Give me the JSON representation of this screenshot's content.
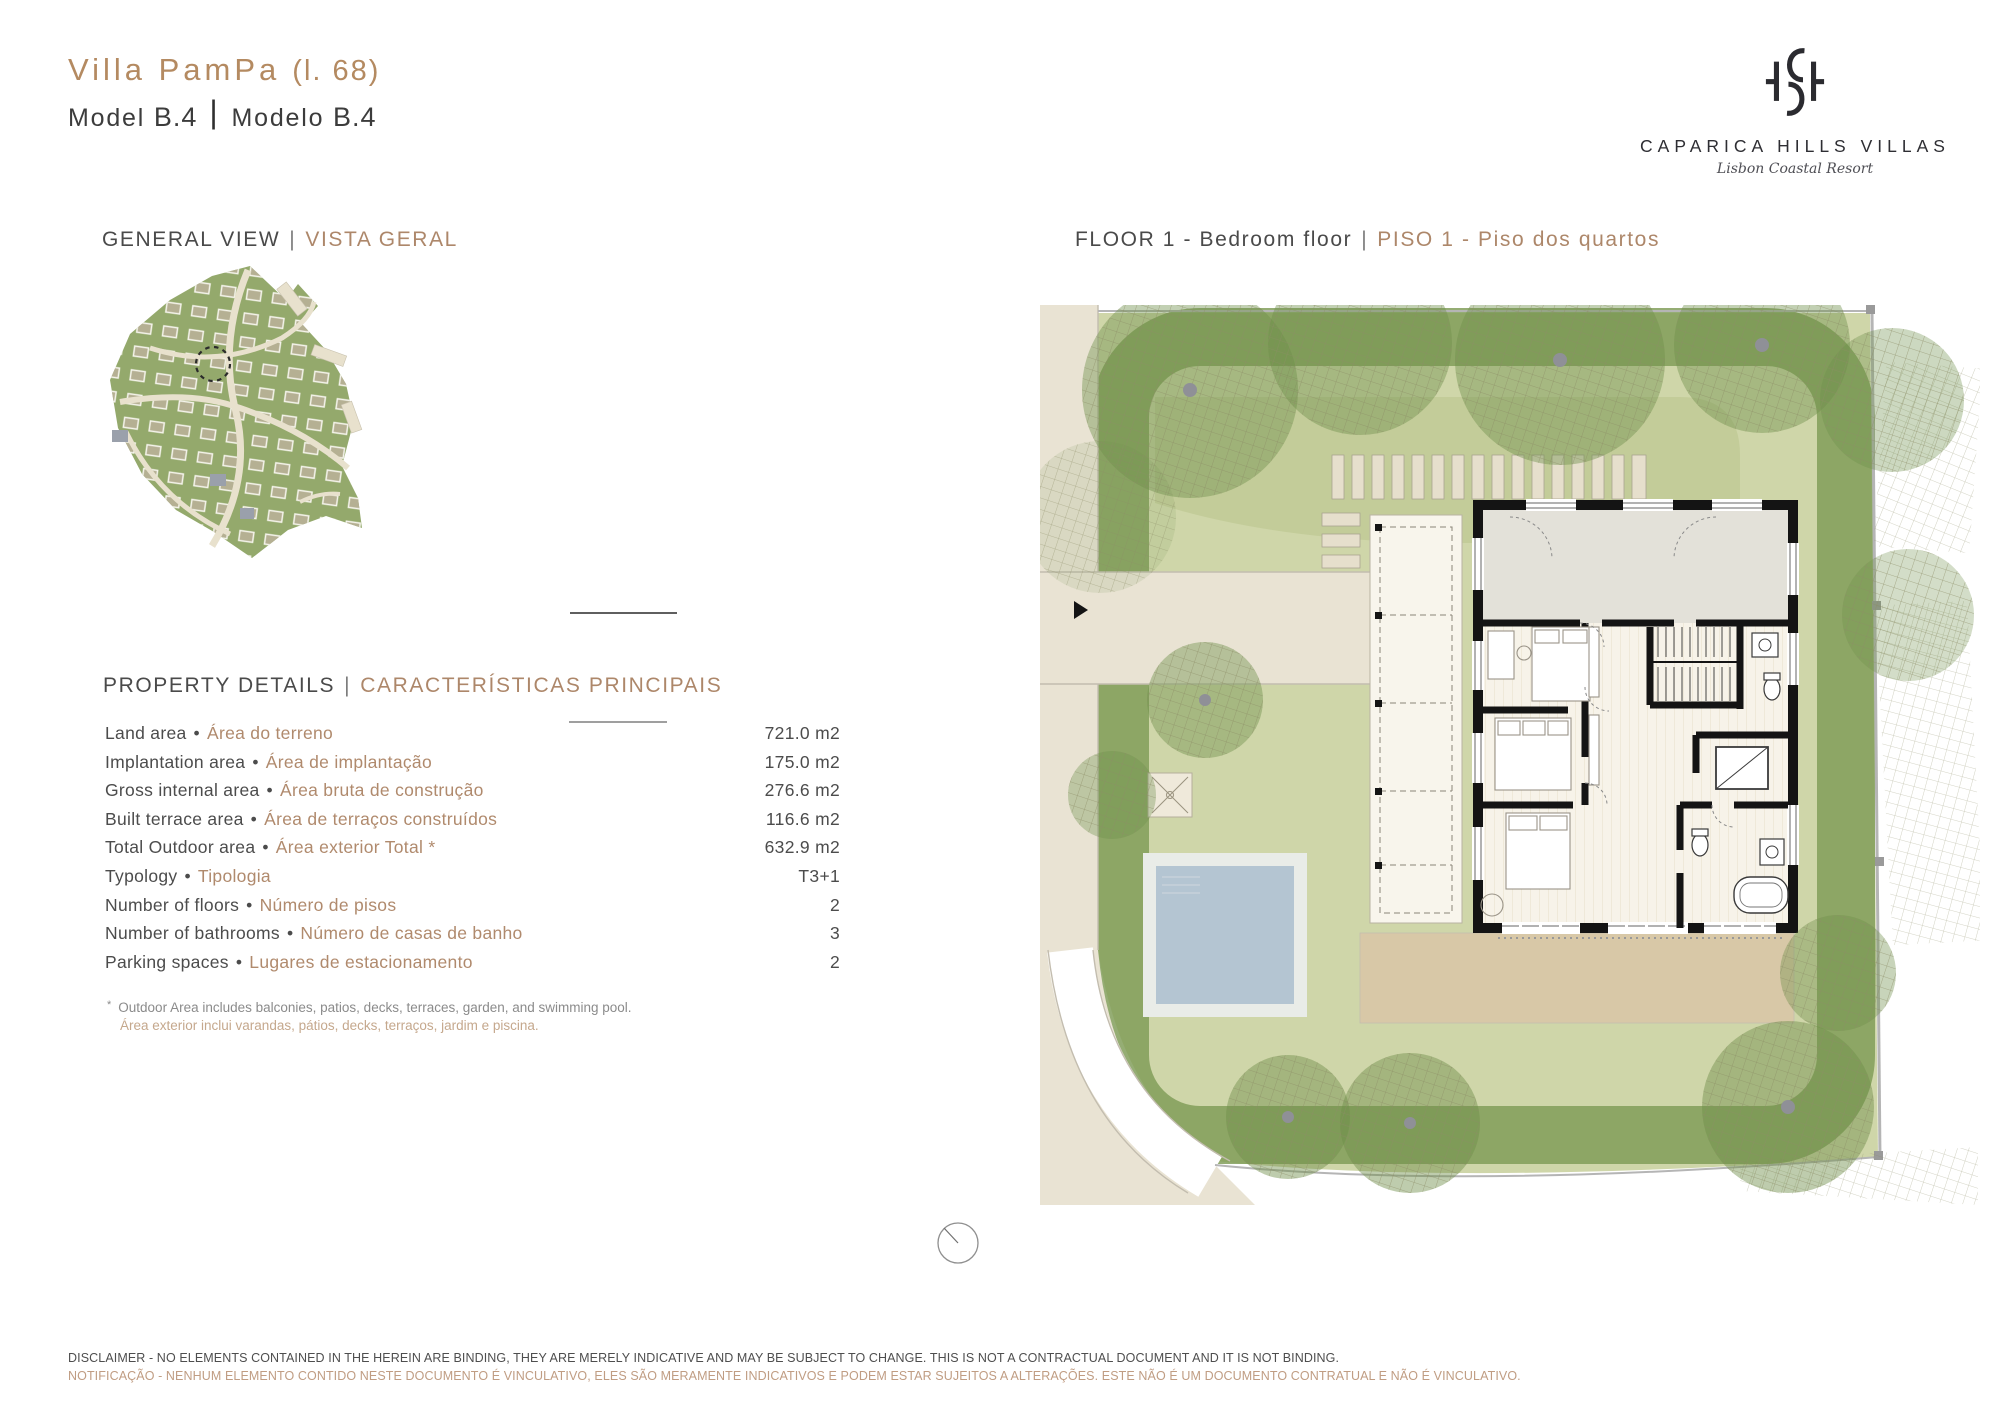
{
  "header": {
    "villa_name": "Villa PamPa",
    "lot": "(l. 68)",
    "model_label_en": "Model",
    "model_value_en": "B.4",
    "separator": "|",
    "model_label_pt": "Modelo",
    "model_value_pt": "B.4"
  },
  "logo": {
    "monogram": "CH",
    "name": "CAPARICA HILLS VILLAS",
    "tagline": "Lisbon Coastal Resort"
  },
  "sections": {
    "general_view": {
      "en": "GENERAL VIEW",
      "sep": "|",
      "pt": "VISTA GERAL"
    },
    "floor": {
      "en": "FLOOR 1 - Bedroom floor",
      "sep": "|",
      "pt": "PISO 1 - Piso dos quartos"
    },
    "property_details": {
      "en": "PROPERTY DETAILS",
      "sep": "|",
      "pt": "CARACTERÍSTICAS PRINCIPAIS"
    }
  },
  "property_details": {
    "bullet": "•",
    "rows": [
      {
        "label_en": "Land area",
        "label_pt": "Área do terreno",
        "value": "721.0 m2"
      },
      {
        "label_en": "Implantation area",
        "label_pt": "Área de implantação",
        "value": "175.0 m2"
      },
      {
        "label_en": "Gross internal area",
        "label_pt": "Área bruta de construção",
        "value": "276.6 m2"
      },
      {
        "label_en": "Built terrace area",
        "label_pt": "Área de terraços construídos",
        "value": "116.6 m2"
      },
      {
        "label_en": "Total Outdoor area",
        "label_pt": "Área exterior Total *",
        "value": "632.9 m2"
      },
      {
        "label_en": "Typology",
        "label_pt": "Tipologia",
        "value": "T3+1"
      },
      {
        "label_en": "Number of floors",
        "label_pt": "Número de pisos",
        "value": "2"
      },
      {
        "label_en": "Number of bathrooms",
        "label_pt": "Número de casas de banho",
        "value": "3"
      },
      {
        "label_en": "Parking spaces",
        "label_pt": "Lugares de estacionamento",
        "value": "2"
      }
    ],
    "footnote_marker": "*",
    "footnote_en": "Outdoor Area includes balconies, patios, decks, terraces, garden, and swimming pool.",
    "footnote_pt": "Área exterior inclui varandas, pátios, decks, terraços, jardim e piscina."
  },
  "disclaimer": {
    "en": "DISCLAIMER - NO ELEMENTS CONTAINED IN THE HEREIN ARE BINDING, THEY ARE MERELY INDICATIVE AND MAY BE SUBJECT TO CHANGE. THIS IS NOT A CONTRACTUAL DOCUMENT AND IT IS NOT BINDING.",
    "pt": "NOTIFICAÇÃO - NENHUM ELEMENTO CONTIDO NESTE DOCUMENTO É VINCULATIVO, ELES SÃO MERAMENTE INDICATIVOS E PODEM ESTAR SUJEITOS A ALTERAÇÕES. ESTE NÃO É UM DOCUMENTO CONTRATUAL E NÃO É VINCULATIVO."
  },
  "colors": {
    "accent_tan": "#b48a61",
    "accent_tan_light": "#c5a88d",
    "text_dark": "#3d3d3d",
    "garden_light_green": "#cfd6a9",
    "garden_dark_green": "#7e9b55",
    "pool_blue": "#b4c5d2",
    "terrace_tan": "#d8c8a7",
    "pavement_beige": "#e9e3d3",
    "wall_black": "#141414"
  }
}
